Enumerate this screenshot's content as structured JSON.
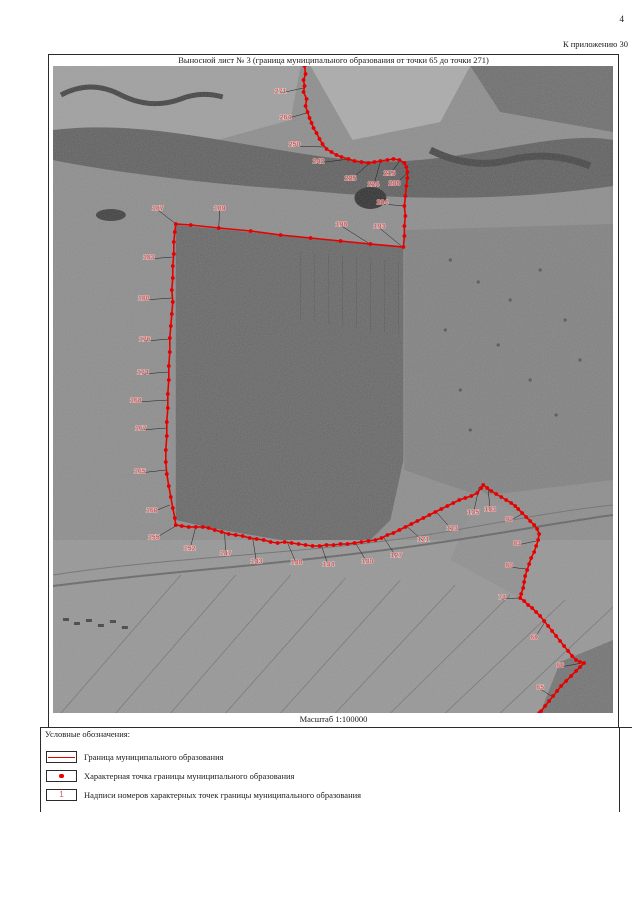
{
  "page": {
    "number": "4",
    "annex_note": "К приложению 30"
  },
  "sheet": {
    "title": "Выносной лист № 3 (граница муниципального образования от точки 65 до точки 271)",
    "scale_label": "Масштаб 1:100000"
  },
  "legend": {
    "heading": "Условные обозначения:",
    "items": [
      {
        "symbol": "boundary-line-symbol",
        "label": "Граница муниципального образования"
      },
      {
        "symbol": "boundary-point-symbol",
        "label": "Характерная точка границы муниципального образования"
      },
      {
        "symbol": "point-number-symbol",
        "symbol_text": "1",
        "label": "Надписи номеров характерных точек границы муниципального образования"
      }
    ]
  },
  "map": {
    "colors": {
      "boundary": "#e60000",
      "point_label": "#d85a5a",
      "leader": "#1b1b1b"
    },
    "boundary_path": [
      [
        304,
        66
      ],
      [
        305,
        74
      ],
      [
        303,
        80
      ],
      [
        304,
        86
      ],
      [
        303,
        92
      ],
      [
        306,
        99
      ],
      [
        305,
        106
      ],
      [
        307,
        112
      ],
      [
        309,
        118
      ],
      [
        311,
        123
      ],
      [
        313,
        128
      ],
      [
        316,
        133
      ],
      [
        319,
        139
      ],
      [
        322,
        144
      ],
      [
        326,
        149
      ],
      [
        331,
        152
      ],
      [
        336,
        155
      ],
      [
        341,
        157
      ],
      [
        348,
        159
      ],
      [
        354,
        161
      ],
      [
        361,
        162
      ],
      [
        368,
        163
      ],
      [
        374,
        162
      ],
      [
        380,
        161
      ],
      [
        387,
        160
      ],
      [
        393,
        159
      ],
      [
        399,
        160
      ],
      [
        404,
        163
      ],
      [
        406,
        167
      ],
      [
        407,
        172
      ],
      [
        407,
        178
      ],
      [
        406,
        186
      ],
      [
        405,
        196
      ],
      [
        404,
        206
      ],
      [
        405,
        216
      ],
      [
        404,
        226
      ],
      [
        404,
        236
      ],
      [
        403,
        247
      ],
      [
        370,
        244
      ],
      [
        340,
        241
      ],
      [
        310,
        238
      ],
      [
        280,
        235
      ],
      [
        250,
        231
      ],
      [
        218,
        228
      ],
      [
        190,
        225
      ],
      [
        175,
        224
      ],
      [
        174,
        232
      ],
      [
        173,
        242
      ],
      [
        173,
        254
      ],
      [
        172,
        266
      ],
      [
        172,
        278
      ],
      [
        171,
        290
      ],
      [
        172,
        302
      ],
      [
        171,
        314
      ],
      [
        170,
        326
      ],
      [
        169,
        338
      ],
      [
        169,
        352
      ],
      [
        168,
        366
      ],
      [
        168,
        380
      ],
      [
        167,
        394
      ],
      [
        167,
        408
      ],
      [
        166,
        422
      ],
      [
        166,
        436
      ],
      [
        165,
        450
      ],
      [
        165,
        462
      ],
      [
        166,
        474
      ],
      [
        168,
        486
      ],
      [
        170,
        497
      ],
      [
        172,
        508
      ],
      [
        174,
        518
      ],
      [
        175,
        525
      ],
      [
        181,
        526
      ],
      [
        188,
        527
      ],
      [
        195,
        527
      ],
      [
        202,
        527
      ],
      [
        208,
        528
      ],
      [
        214,
        530
      ],
      [
        221,
        532
      ],
      [
        228,
        534
      ],
      [
        235,
        535
      ],
      [
        242,
        536
      ],
      [
        249,
        538
      ],
      [
        256,
        539
      ],
      [
        263,
        540
      ],
      [
        270,
        542
      ],
      [
        277,
        543
      ],
      [
        284,
        542
      ],
      [
        291,
        543
      ],
      [
        298,
        544
      ],
      [
        305,
        545
      ],
      [
        312,
        546
      ],
      [
        319,
        546
      ],
      [
        326,
        545
      ],
      [
        333,
        545
      ],
      [
        340,
        544
      ],
      [
        347,
        544
      ],
      [
        354,
        543
      ],
      [
        361,
        542
      ],
      [
        368,
        541
      ],
      [
        375,
        540
      ],
      [
        381,
        538
      ],
      [
        387,
        535
      ],
      [
        393,
        533
      ],
      [
        399,
        530
      ],
      [
        405,
        527
      ],
      [
        411,
        524
      ],
      [
        417,
        521
      ],
      [
        423,
        518
      ],
      [
        429,
        515
      ],
      [
        435,
        512
      ],
      [
        441,
        509
      ],
      [
        447,
        506
      ],
      [
        453,
        503
      ],
      [
        459,
        500
      ],
      [
        465,
        498
      ],
      [
        471,
        496
      ],
      [
        477,
        493
      ],
      [
        481,
        488
      ],
      [
        483,
        485
      ],
      [
        487,
        488
      ],
      [
        491,
        491
      ],
      [
        496,
        494
      ],
      [
        501,
        497
      ],
      [
        506,
        500
      ],
      [
        511,
        503
      ],
      [
        515,
        506
      ],
      [
        518,
        509
      ],
      [
        522,
        513
      ],
      [
        526,
        517
      ],
      [
        530,
        521
      ],
      [
        534,
        525
      ],
      [
        537,
        529
      ],
      [
        539,
        534
      ],
      [
        538,
        540
      ],
      [
        536,
        546
      ],
      [
        534,
        552
      ],
      [
        531,
        558
      ],
      [
        529,
        564
      ],
      [
        527,
        570
      ],
      [
        525,
        576
      ],
      [
        524,
        582
      ],
      [
        523,
        588
      ],
      [
        521,
        594
      ],
      [
        520,
        598
      ],
      [
        524,
        601
      ],
      [
        528,
        605
      ],
      [
        532,
        608
      ],
      [
        536,
        612
      ],
      [
        540,
        616
      ],
      [
        544,
        621
      ],
      [
        548,
        626
      ],
      [
        552,
        631
      ],
      [
        556,
        636
      ],
      [
        560,
        641
      ],
      [
        564,
        646
      ],
      [
        568,
        651
      ],
      [
        572,
        656
      ],
      [
        576,
        660
      ],
      [
        580,
        662
      ],
      [
        584,
        663
      ],
      [
        580,
        667
      ],
      [
        576,
        671
      ],
      [
        571,
        676
      ],
      [
        566,
        681
      ],
      [
        561,
        686
      ],
      [
        557,
        691
      ],
      [
        553,
        696
      ],
      [
        549,
        701
      ],
      [
        545,
        706
      ],
      [
        541,
        711
      ],
      [
        539,
        713
      ]
    ],
    "point_labels": [
      {
        "n": "271",
        "x": 280,
        "y": 91,
        "ax": 303,
        "ay": 88
      },
      {
        "n": "264",
        "x": 285,
        "y": 117,
        "ax": 306,
        "ay": 113
      },
      {
        "n": "250",
        "x": 294,
        "y": 144,
        "ax": 324,
        "ay": 147
      },
      {
        "n": "242",
        "x": 318,
        "y": 161,
        "ax": 348,
        "ay": 159
      },
      {
        "n": "225",
        "x": 350,
        "y": 178,
        "ax": 368,
        "ay": 164
      },
      {
        "n": "224",
        "x": 373,
        "y": 184,
        "ax": 380,
        "ay": 162
      },
      {
        "n": "215",
        "x": 389,
        "y": 173,
        "ax": 400,
        "ay": 160
      },
      {
        "n": "208",
        "x": 394,
        "y": 183,
        "ax": 406,
        "ay": 174
      },
      {
        "n": "204",
        "x": 382,
        "y": 202,
        "ax": 404,
        "ay": 206
      },
      {
        "n": "198",
        "x": 341,
        "y": 224,
        "ax": 371,
        "ay": 245
      },
      {
        "n": "193",
        "x": 379,
        "y": 226,
        "ax": 401,
        "ay": 246
      },
      {
        "n": "189",
        "x": 219,
        "y": 208,
        "ax": 218,
        "ay": 228
      },
      {
        "n": "187",
        "x": 157,
        "y": 208,
        "ax": 174,
        "ay": 223
      },
      {
        "n": "183",
        "x": 148,
        "y": 257,
        "ax": 172,
        "ay": 257
      },
      {
        "n": "180",
        "x": 143,
        "y": 298,
        "ax": 171,
        "ay": 298
      },
      {
        "n": "176",
        "x": 144,
        "y": 339,
        "ax": 169,
        "ay": 339
      },
      {
        "n": "174",
        "x": 142,
        "y": 372,
        "ax": 168,
        "ay": 372
      },
      {
        "n": "168",
        "x": 135,
        "y": 400,
        "ax": 168,
        "ay": 400
      },
      {
        "n": "167",
        "x": 140,
        "y": 428,
        "ax": 166,
        "ay": 428
      },
      {
        "n": "165",
        "x": 139,
        "y": 471,
        "ax": 165,
        "ay": 470
      },
      {
        "n": "160",
        "x": 151,
        "y": 510,
        "ax": 169,
        "ay": 505
      },
      {
        "n": "155",
        "x": 153,
        "y": 537,
        "ax": 175,
        "ay": 526
      },
      {
        "n": "152",
        "x": 189,
        "y": 548,
        "ax": 195,
        "ay": 527
      },
      {
        "n": "147",
        "x": 225,
        "y": 553,
        "ax": 224,
        "ay": 533
      },
      {
        "n": "143",
        "x": 256,
        "y": 561,
        "ax": 252,
        "ay": 538
      },
      {
        "n": "138",
        "x": 296,
        "y": 562,
        "ax": 287,
        "ay": 543
      },
      {
        "n": "134",
        "x": 328,
        "y": 564,
        "ax": 321,
        "ay": 546
      },
      {
        "n": "130",
        "x": 367,
        "y": 561,
        "ax": 355,
        "ay": 543
      },
      {
        "n": "127",
        "x": 396,
        "y": 555,
        "ax": 383,
        "ay": 537
      },
      {
        "n": "121",
        "x": 423,
        "y": 539,
        "ax": 406,
        "ay": 526
      },
      {
        "n": "113",
        "x": 452,
        "y": 528,
        "ax": 435,
        "ay": 511
      },
      {
        "n": "105",
        "x": 473,
        "y": 512,
        "ax": 479,
        "ay": 487
      },
      {
        "n": "103",
        "x": 490,
        "y": 509,
        "ax": 488,
        "ay": 490
      },
      {
        "n": "90",
        "x": 509,
        "y": 519,
        "ax": 522,
        "ay": 514
      },
      {
        "n": "83",
        "x": 517,
        "y": 543,
        "ax": 536,
        "ay": 541
      },
      {
        "n": "80",
        "x": 509,
        "y": 565,
        "ax": 526,
        "ay": 569
      },
      {
        "n": "74",
        "x": 502,
        "y": 597,
        "ax": 518,
        "ay": 598
      },
      {
        "n": "69",
        "x": 534,
        "y": 637,
        "ax": 546,
        "ay": 620
      },
      {
        "n": "66",
        "x": 560,
        "y": 665,
        "ax": 582,
        "ay": 663
      },
      {
        "n": "65",
        "x": 540,
        "y": 687,
        "ax": 553,
        "ay": 697
      }
    ]
  }
}
